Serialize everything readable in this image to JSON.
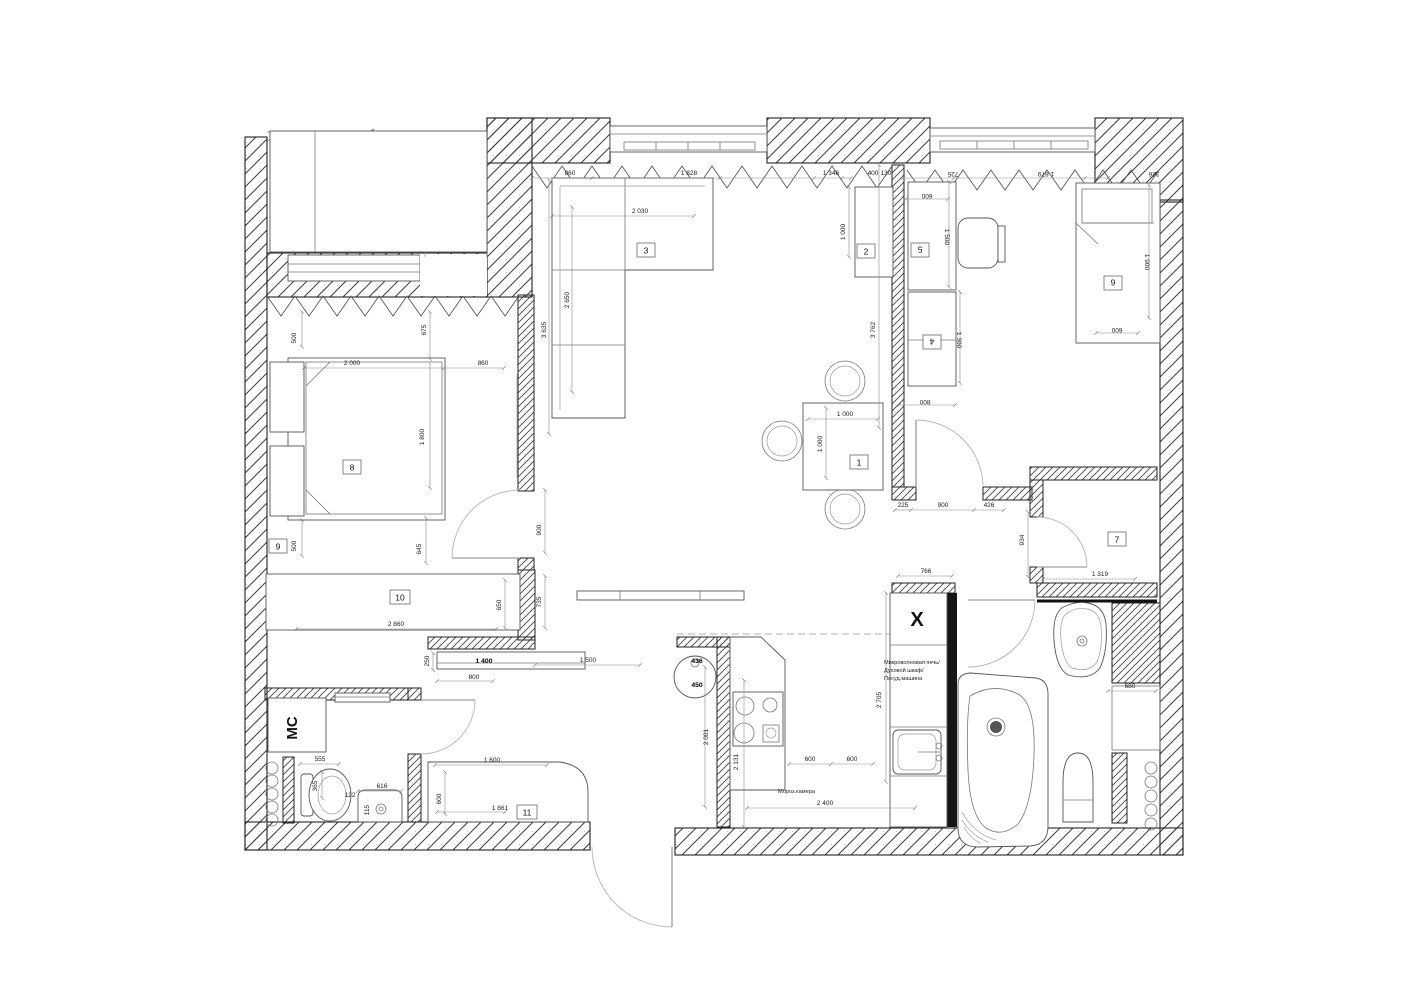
{
  "markers": {
    "m1": "1",
    "m2": "2",
    "m3": "3",
    "m4": "4",
    "m5": "5",
    "m6": "6",
    "m7": "7",
    "m8": "8",
    "m9": "9",
    "m10": "10",
    "m11": "11"
  },
  "labels": {
    "fridge": "X",
    "washer": "МС",
    "kitchen_stack": [
      "Микроволновая печь/",
      "Духовой шкаф/",
      "Посуд.машина"
    ],
    "freezer": "Мороз.камера"
  },
  "dims": {
    "top_860": "860",
    "top_1828": "1 828",
    "top_1346": "1 346",
    "top_400": "400",
    "top_130": "130",
    "kids_725": "725",
    "kids_1879": "1 879",
    "kids_326": "326",
    "sofa_2030": "2 030",
    "sofa_2650": "2 650",
    "living_3635": "3 635",
    "bed_675": "675",
    "ns_top_500": "500",
    "bed_2000": "2 000",
    "bed_860": "860",
    "bed_1800": "1 800",
    "ns_bot_500": "500",
    "bed_645": "645",
    "door_900": "900",
    "corr_735": "735",
    "w10_650": "650",
    "w10_2860": "2 860",
    "tv_250": "250",
    "tv_1400": "1 400",
    "tv_800": "800",
    "hall_1500": "1 500",
    "st_436": "436",
    "st_450": "450",
    "w11_1600": "1 600",
    "w11_600": "600",
    "w11_1861": "1 861",
    "wc_555": "555",
    "wc_365": "365",
    "wc_122": "122",
    "wc_616": "616",
    "wc_115": "115",
    "k_2001": "2 001",
    "k_2131": "2 131",
    "k_600a": "600",
    "k_600b": "600",
    "k_2705": "2 705",
    "k_2400": "2 400",
    "k_766": "766",
    "t_1000w": "1 000",
    "t_1000d": "1 000",
    "lob_225": "225",
    "lob_900": "900",
    "lob_426": "426",
    "lob_934": "934",
    "kids_800": "800",
    "c2_1000": "1 000",
    "kids_3762": "3 762",
    "desk_600": "600",
    "desk_1500": "1 500",
    "cab_1300": "1 300",
    "bed6_1900": "1 900",
    "bed6_600": "600",
    "h7_1319": "1 319",
    "bath_680": "680"
  }
}
